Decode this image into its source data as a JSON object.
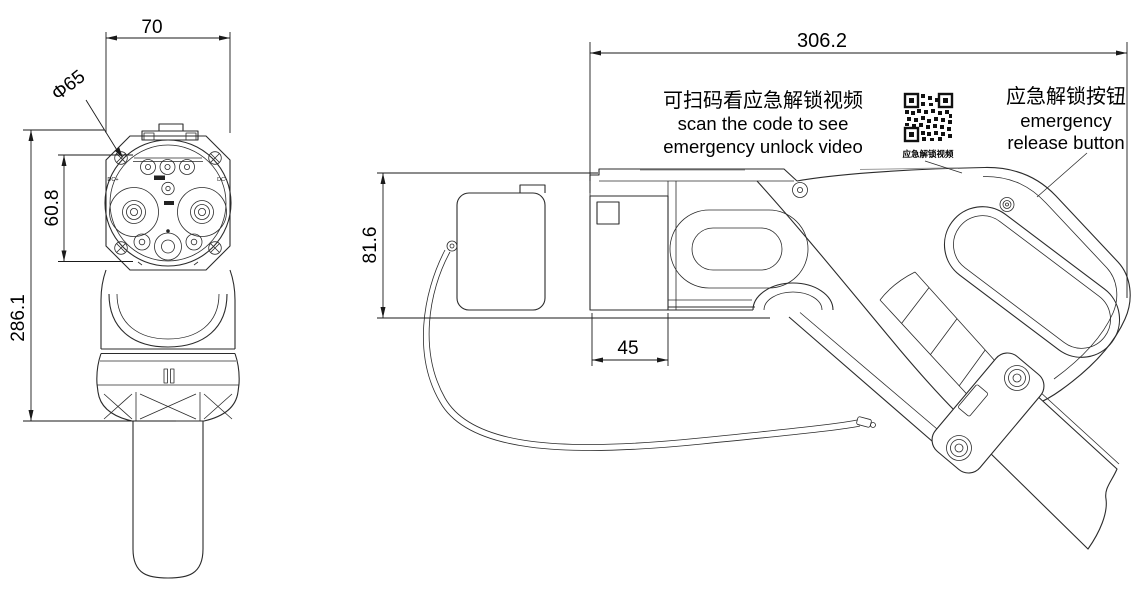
{
  "drawing": {
    "front_view": {
      "dim_width": "70",
      "dim_diameter": "Φ65",
      "dim_pin_span": "60.8",
      "dim_length": "286.1",
      "label_dc_plus": "DC+",
      "label_dc_minus": "DC-"
    },
    "side_view": {
      "dim_overall_length": "306.2",
      "dim_height": "81.6",
      "dim_nozzle": "45"
    },
    "annotations": {
      "qr_note_zh": "可扫码看应急解锁视频",
      "qr_note_en_line1": "scan the code to see",
      "qr_note_en_line2": "emergency unlock video",
      "qr_caption": "应急解锁视频",
      "release_zh": "应急解锁按钮",
      "release_en_line1": "emergency",
      "release_en_line2": "release button"
    },
    "colors": {
      "line": "#2b2b2b",
      "text": "#000000",
      "background": "#ffffff",
      "light_line": "#9a9a9a"
    }
  }
}
